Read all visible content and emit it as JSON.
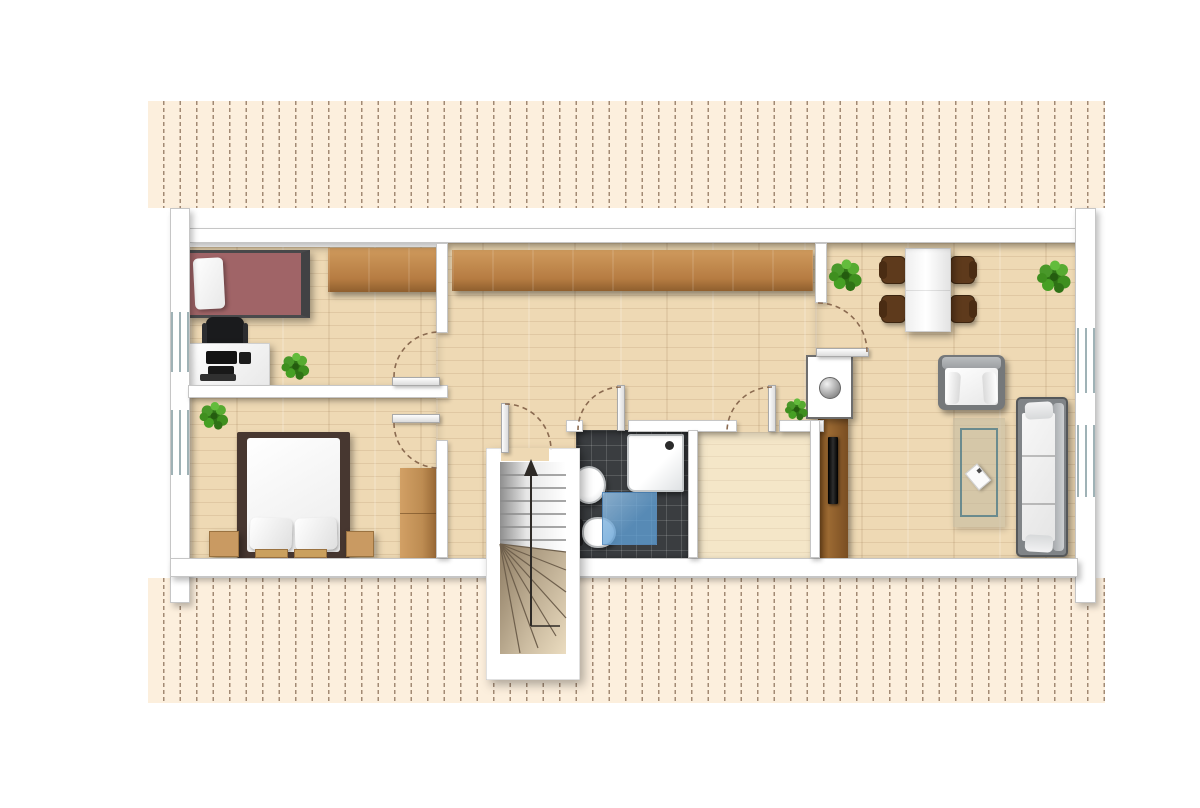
{
  "document": {
    "kind": "floor-plan",
    "visible_text_labels": []
  },
  "palette": {
    "hatch_bg": "#fcefdd",
    "hatch_line": "#a28a74",
    "wall_fill": "#ffffff",
    "wall_edge": "#c6c6c6",
    "wood_floor": "#eed9b4",
    "wood_floor_light": "#f4e6c8",
    "wardrobe_wood": "#b67c42",
    "tile_dark": "#3a3d40",
    "bed_red": "#a06467",
    "bed_frame_dark": "#473730",
    "chair_brown": "#5e3a1c",
    "plant_green": "#3f8f1f",
    "mat_blue": "#5aa0d2",
    "arc_brown": "#8a6a50",
    "tv_black": "#141414",
    "sofa_gray": "#808487"
  },
  "rooms": [
    {
      "id": "bedroom-top-left",
      "furniture": [
        "single-bed",
        "pillow",
        "wardrobe",
        "desk",
        "office-chair",
        "computer-equipment",
        "plant"
      ]
    },
    {
      "id": "bedroom-bottom-left",
      "furniture": [
        "double-bed",
        "pillow",
        "pillow",
        "nightstand",
        "nightstand",
        "wardrobe",
        "plant"
      ]
    },
    {
      "id": "hallway",
      "furniture": [
        "built-in-wardrobe",
        "plant"
      ]
    },
    {
      "id": "stairwell",
      "furniture": [
        "winder-staircase",
        "up-direction-arrow"
      ]
    },
    {
      "id": "bathroom",
      "furniture": [
        "shower-tray",
        "washbasin",
        "toilet",
        "bath-mat"
      ]
    },
    {
      "id": "storage-room",
      "furniture": []
    },
    {
      "id": "living-dining-room",
      "furniture": [
        "dining-table",
        "dining-chair",
        "dining-chair",
        "dining-chair",
        "dining-chair",
        "armchair",
        "sofa",
        "rug",
        "coffee-tray",
        "flat-tv",
        "tv-panel",
        "chimney",
        "plant",
        "plant"
      ]
    }
  ],
  "doors": [
    "bedroom-top-door",
    "bedroom-bottom-door",
    "stairwell-door",
    "bathroom-door",
    "storage-door",
    "living-room-door"
  ],
  "windows": [
    "left-window-1",
    "left-window-2",
    "right-window-1",
    "right-window-2"
  ]
}
